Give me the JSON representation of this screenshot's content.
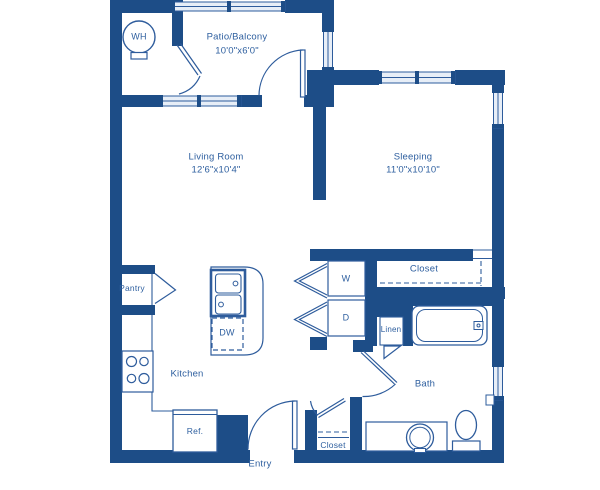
{
  "colors": {
    "wall": "#1d4d87",
    "line": "#2e5c9c",
    "text": "#2e5f9f",
    "window_pane": "#e7eef7"
  },
  "rooms": {
    "patio": {
      "label": "Patio/Balcony",
      "dimensions": "10'0\"x6'0\""
    },
    "living": {
      "label": "Living Room",
      "dimensions": "12'6\"x10'4\""
    },
    "sleeping": {
      "label": "Sleeping",
      "dimensions": "11'0\"x10'10\""
    },
    "kitchen": {
      "label": "Kitchen"
    },
    "bath": {
      "label": "Bath"
    },
    "entry": {
      "label": "Entry"
    },
    "pantry": {
      "label": "Pantry"
    },
    "linen": {
      "label": "Linen"
    },
    "bedroom_closet": {
      "label": "Closet"
    },
    "entry_closet": {
      "label": "Closet"
    }
  },
  "fixtures": {
    "water_heater": {
      "label": "WH"
    },
    "washer": {
      "label": "W"
    },
    "dryer": {
      "label": "D"
    },
    "dishwasher": {
      "label": "DW"
    },
    "refrigerator": {
      "label": "Ref."
    }
  }
}
